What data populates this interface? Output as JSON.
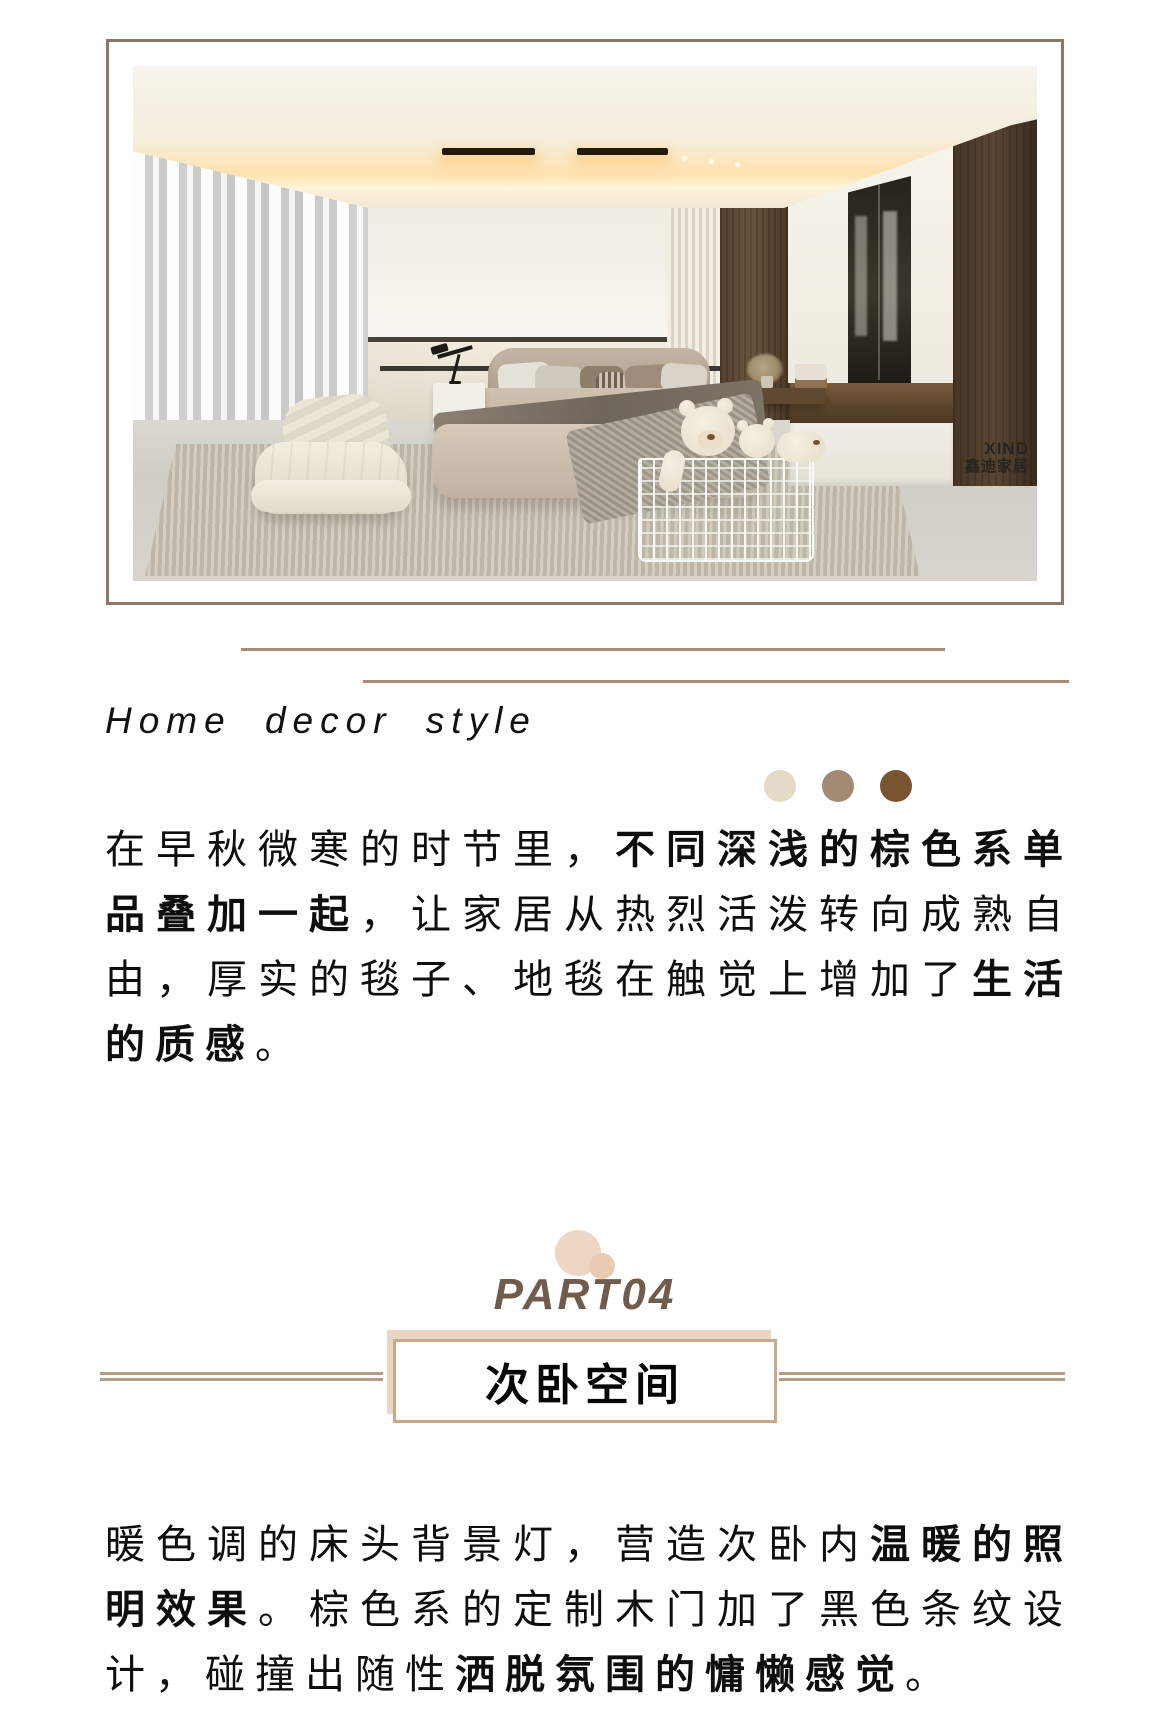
{
  "hero": {
    "watermark": {
      "logo": "XIND",
      "name": "鑫迪家居"
    }
  },
  "section_header": {
    "title": "Home decor style",
    "palette_dots": [
      {
        "color": "#e4dac8"
      },
      {
        "color": "#a18974"
      },
      {
        "color": "#785430"
      }
    ]
  },
  "intro_paragraph": {
    "segments": [
      {
        "t": "在早秋微寒的时节里，",
        "b": false
      },
      {
        "t": "不同深浅的棕色系单品叠加一起",
        "b": true
      },
      {
        "t": "，让家居从热烈活泼转向成熟自由，厚实的毯子、地毯在触觉上增加了",
        "b": false
      },
      {
        "t": "生活的质感",
        "b": true
      },
      {
        "t": "。",
        "b": false
      }
    ]
  },
  "part_section": {
    "label": "PART04",
    "label_color": "#6f5c4c",
    "title": "次卧空间",
    "box_border_color": "#c9a98c",
    "box_shadow_color": "#ead6c4",
    "line_color": "#b39e8a",
    "circle_colors": [
      "#eed6c5",
      "#e9cab2"
    ],
    "divider_color": "#a78d76"
  },
  "body_paragraph": {
    "segments": [
      {
        "t": "暖色调的床头背景灯，营造次卧内",
        "b": false
      },
      {
        "t": "温暖的照明效果",
        "b": true
      },
      {
        "t": "。棕色系的定制木门加了黑色条纹设计，碰撞出随性",
        "b": false
      },
      {
        "t": "洒脱氛围的慵懒感觉",
        "b": true
      },
      {
        "t": "。",
        "b": false
      }
    ]
  }
}
